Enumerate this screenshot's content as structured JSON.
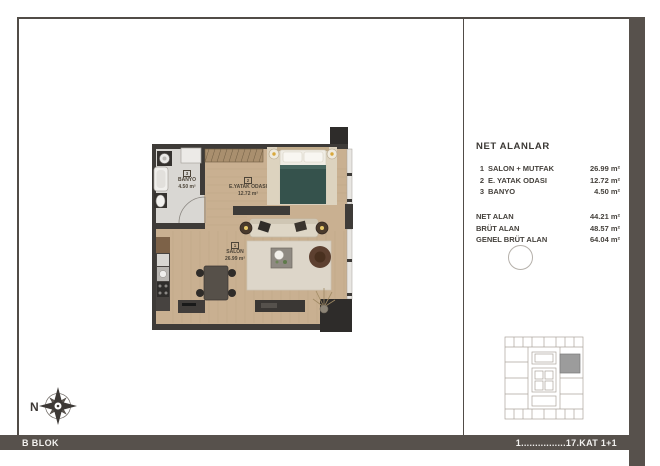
{
  "footer": {
    "block": "B BLOK",
    "floors": "1................17.KAT 1+1"
  },
  "net_alanlar": {
    "title": "NET ALANLAR",
    "rooms": [
      {
        "no": "1",
        "name": "SALON + MUTFAK",
        "area": "26.99 m²"
      },
      {
        "no": "2",
        "name": "E. YATAK ODASI",
        "area": "12.72 m²"
      },
      {
        "no": "3",
        "name": "BANYO",
        "area": "4.50  m²"
      }
    ],
    "totals": [
      {
        "label": "NET ALAN",
        "value": "44.21 m²"
      },
      {
        "label": "BRÜT ALAN",
        "value": "48.57 m²"
      },
      {
        "label": "GENEL BRÜT ALAN",
        "value": "64.04 m²"
      }
    ]
  },
  "floor_plan": {
    "labels": {
      "banyo": {
        "no": "3",
        "name": "BANYO",
        "area": "4.50 m²"
      },
      "bedroom": {
        "no": "2",
        "name": "E.YATAK ODASI",
        "area": "12.72 m²"
      },
      "salon": {
        "no": "1",
        "name": "SALON",
        "area": "26.99 m²"
      }
    }
  },
  "compass": {
    "label": "N"
  },
  "palette": {
    "frame": "#514c47",
    "bar": "#57514c",
    "wall": "#3e3b38",
    "wood_floor": "#c9b091",
    "bath_floor": "#d9d7d3",
    "bed_blanket": "#35524c",
    "rug": "#ddd6c9",
    "key_plan_highlight": "#9c9c9c"
  }
}
